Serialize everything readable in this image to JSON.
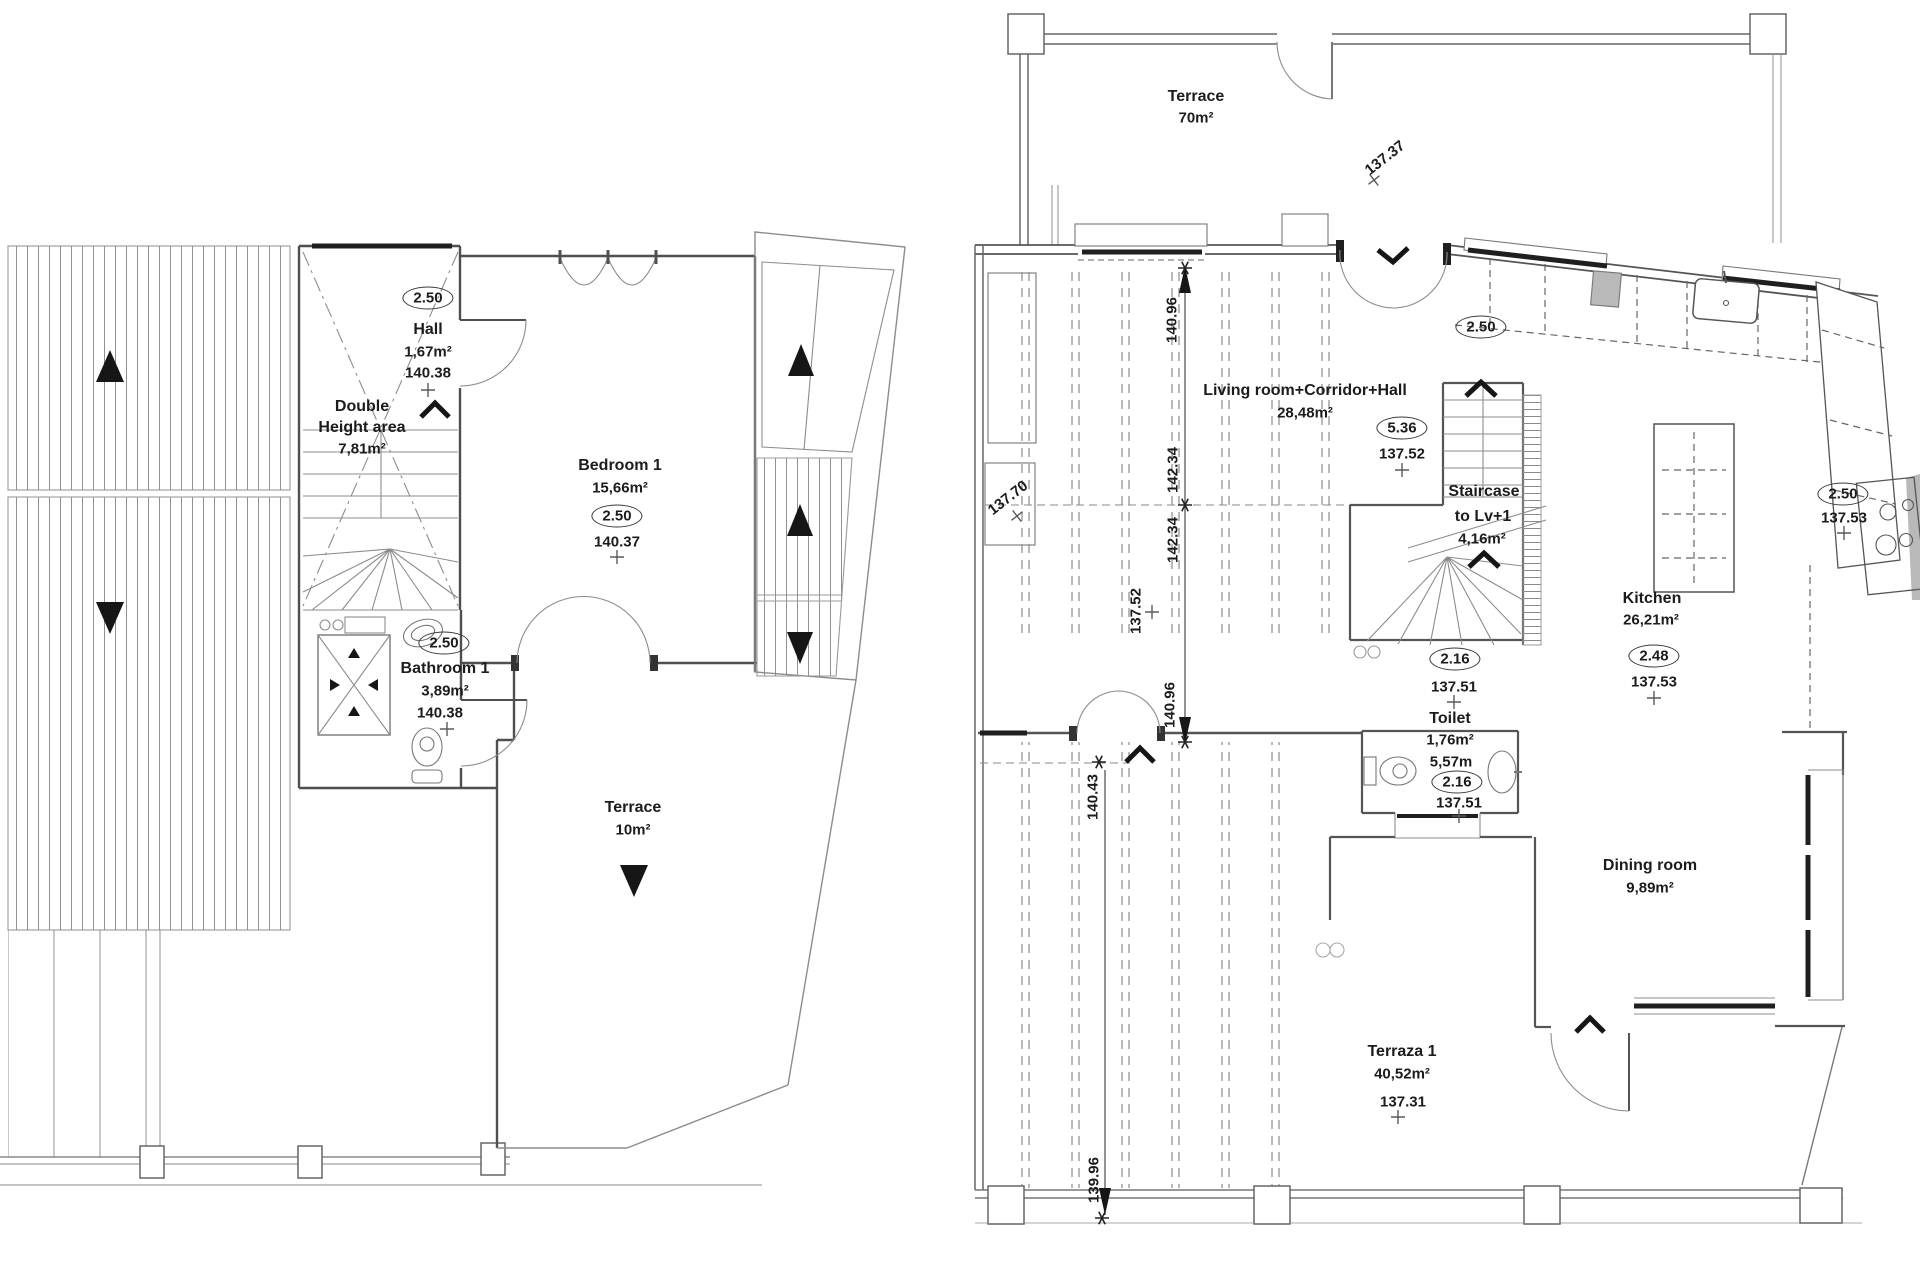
{
  "left_plan": {
    "hall": {
      "badge": "2.50",
      "name": "Hall",
      "area": "1,67m²",
      "level": "140.38"
    },
    "double_height_area": {
      "line1": "Double",
      "line2": "Height area",
      "line3": "7,81m²"
    },
    "bedroom_1": {
      "name": "Bedroom 1",
      "area": "15,66m²",
      "badge": "2.50",
      "level": "140.37"
    },
    "bathroom_1": {
      "badge": "2.50",
      "name": "Bathroom 1",
      "area": "3,89m²",
      "level": "140.38"
    },
    "terrace": {
      "name": "Terrace",
      "area": "10m²"
    }
  },
  "right_plan": {
    "terrace": {
      "name": "Terrace",
      "area": "70m²",
      "spot_level": "137.37"
    },
    "living_room": {
      "name": "Living room+Corridor+Hall",
      "area": "28,48m²",
      "badge": "5.36",
      "level": "137.52"
    },
    "entry_badge": "2.50",
    "staircase": {
      "name_line1": "Staircase",
      "name_line2": "to Lv+1",
      "area": "4,16m²",
      "badge": "2.16",
      "level": "137.51"
    },
    "kitchen": {
      "name": "Kitchen",
      "area": "26,21m²",
      "badge": "2.48",
      "level": "137.53"
    },
    "kitchen_right": {
      "badge": "2.50",
      "level": "137.53"
    },
    "toilet": {
      "name": "Toilet",
      "area": "1,76m²",
      "perimeter": "5,57m",
      "badge": "2.16",
      "level": "137.51"
    },
    "dining_room": {
      "name": "Dining room",
      "area": "9,89m²"
    },
    "terraza_1": {
      "name": "Terraza 1",
      "area": "40,52m²",
      "spot_level": "137.31"
    },
    "spot_levels": {
      "left_planter": "137.70",
      "corridor_vertical": "137.52"
    },
    "dimensions": {
      "top": "140.96",
      "upper_a": "142.34",
      "upper_b": "142.34",
      "mid": "140.96",
      "lower": "140.43",
      "bottom": "139.96"
    }
  },
  "colors": {
    "wall": "#4f4f4f",
    "thin_line": "#8c8c8c",
    "dark": "#1f1f1f",
    "text": "#1c1c1c",
    "appliance_gray": "#b9b9b9"
  }
}
